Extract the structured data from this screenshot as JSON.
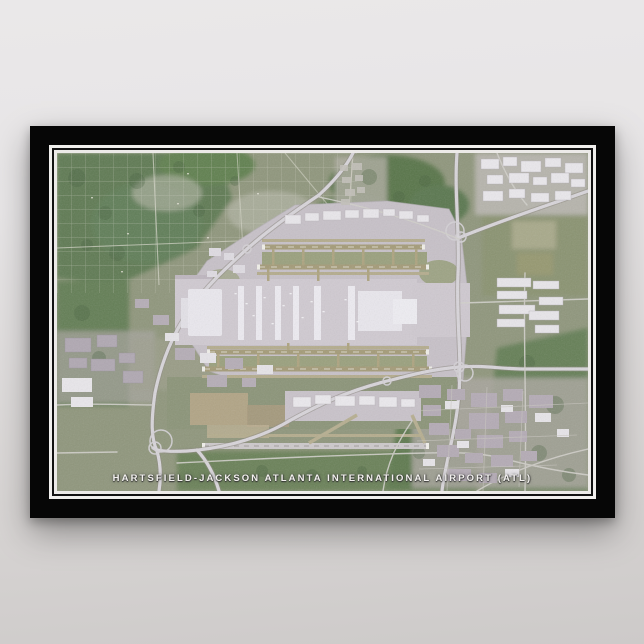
{
  "poster": {
    "title": "HARTSFIELD-JACKSON ATLANTA INTERNATIONAL AIRPORT (ATL)",
    "type_label": "satellite map poster"
  },
  "colors": {
    "backdrop_top": "#eae8e9",
    "backdrop_bottom": "#cdcac9",
    "frame": "#060606",
    "pinstripe": "#f0efed",
    "forest_green": "#5e7a52",
    "suburb_green": "#8f967c",
    "tarmac": "#c7c1c8",
    "runway_khaki": "#a49b78",
    "runway_concrete": "#cdc9cb",
    "terminal_white": "#edebf1",
    "highway": "#d8d5da",
    "dirt_tan": "#b3a486",
    "title_text": "#f3f1ef"
  }
}
